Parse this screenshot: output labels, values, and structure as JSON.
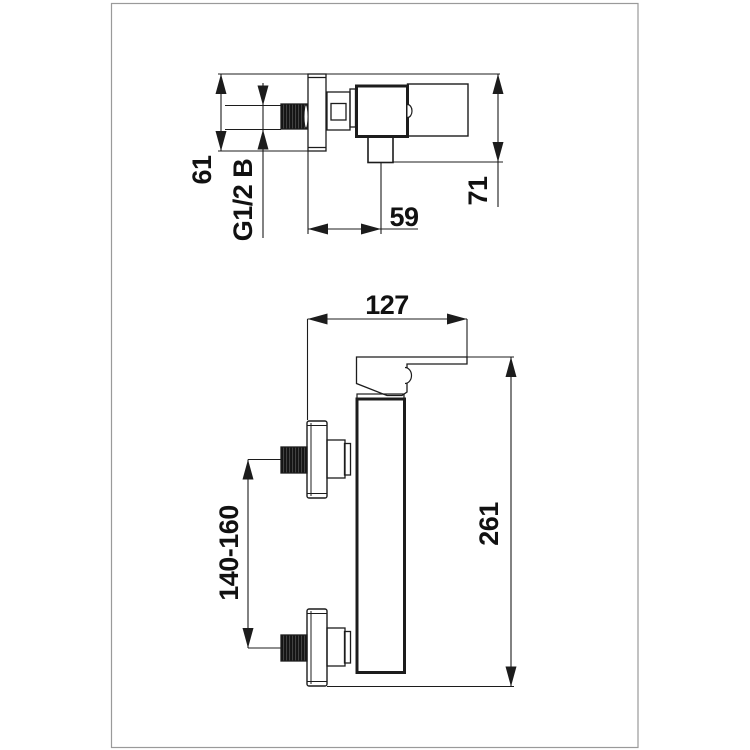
{
  "colors": {
    "background": "#ffffff",
    "frame": "#9a9a9a",
    "line": "#1c1c1c",
    "label": "#111111",
    "thread_fill": "#141414"
  },
  "side_view": {
    "dims": {
      "flange_height": "61",
      "thread_size": "G1/2 B",
      "outlet_offset": "59",
      "total_depth": "71"
    }
  },
  "front_view": {
    "dims": {
      "lever_reach": "127",
      "inlet_spacing": "140-160",
      "total_height": "261"
    }
  }
}
